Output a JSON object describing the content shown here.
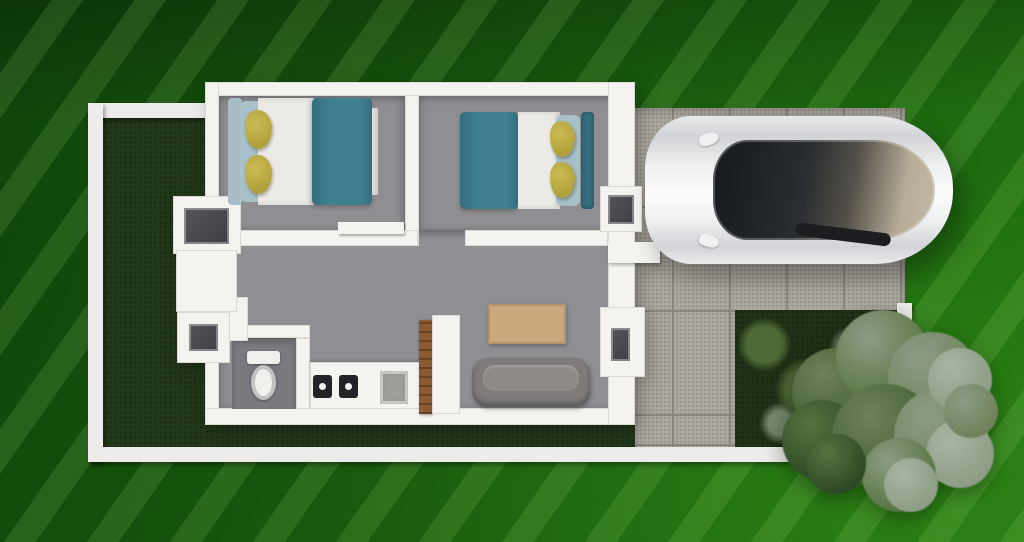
{
  "scene": {
    "type": "3d-top-down-floor-plan-render",
    "setting": "small walled house lot with driveway, car and garden on a green striped backdrop"
  },
  "objects": {
    "property": "white boundary wall around lot",
    "front_yard": "dark grass side yard",
    "house": "two-bedroom house, white walls, gray floors",
    "bedroom_1": "left bedroom with double bed",
    "bedroom_2": "right bedroom with double bed",
    "bed": "teal duvet, white sheets, yellow pillows",
    "bathroom": "bathroom with toilet",
    "kitchen": "counter with two-burner cooktop and sink",
    "living_room": "gray sofa and wooden rug table",
    "entry_door": "open wooden door",
    "driveway": "gray paver tiles",
    "car": "white sedan with dark glass roof",
    "rear_lawn": "garden lawn with shrubs",
    "tree": "tree canopy at rear corner of lot"
  },
  "colors": {
    "bg1": "#0f430a",
    "bg2": "#17570d",
    "bg3": "#217410",
    "stripe": "rgba(180,240,130,0.13)",
    "bound": "#edecea",
    "wall": "#f4f3f0",
    "wall_edge": "#dcd9d4",
    "grass": "#22381a",
    "grass_dot": "rgba(8,18,4,0.35)",
    "lawn": "#1e3315",
    "shrub1": "#4e6836",
    "shrub2": "#75866b",
    "paver": "#aca89f",
    "paver_joint": "#8b877f",
    "floor": "#8f8e92",
    "bath_floor": "#7a797f",
    "teal": "#3e7f90",
    "teal_dark": "#356d7e",
    "sheet": "#eceae5",
    "pillow_y": "#b1a13c",
    "pillow_b": "#a7c0c9",
    "headboard": "#a8bcc3",
    "sofa": "#7e7b7a",
    "sofa_seat": "#8d8a88",
    "table": "#c9a87c",
    "door_wood": "#8d5b33",
    "burner": "#232227",
    "sink": "#a09e99",
    "toilet": "#f1f0ed",
    "pane": "#54555b",
    "car": "#eef0f1",
    "car_shade": "#d2d4d7",
    "glass1": "#15181c",
    "glass2": "#2b2e30",
    "glass3": "#b6ac97",
    "tree1": "#2c4724",
    "tree2": "#3f5c31",
    "tree3": "#56733f",
    "tree4": "#6e8159",
    "tree5": "#8d9c85",
    "tree6": "#a8b5a2"
  }
}
